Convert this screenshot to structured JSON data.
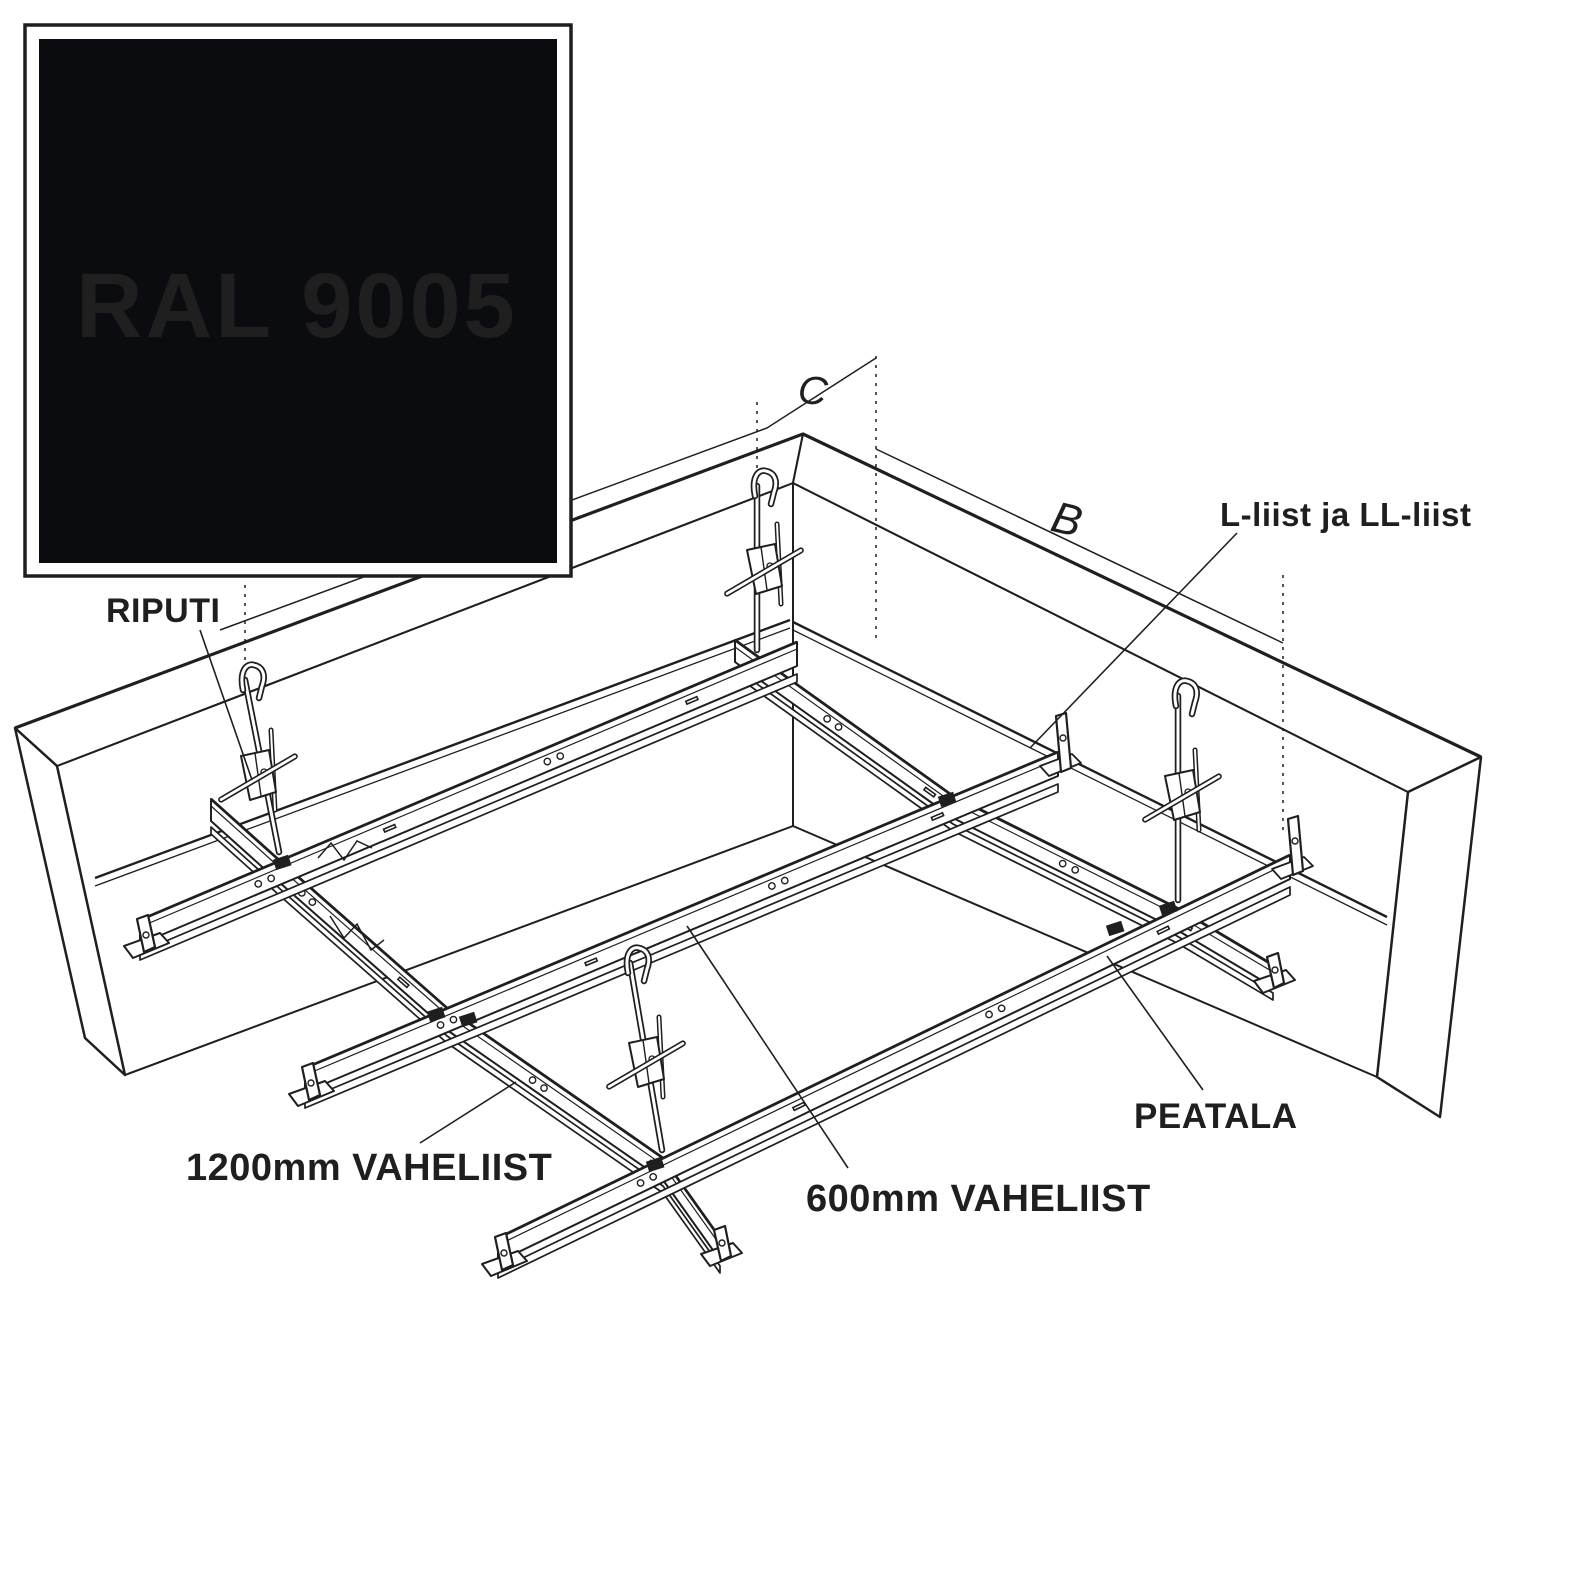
{
  "swatch": {
    "label": "RAL 9005",
    "color": "#0a0c10",
    "text_color": "#ffffff"
  },
  "annotations": {
    "riputi": "RIPUTI",
    "l_liist": "L-liist ja LL-liist",
    "vaheliist_1200": "1200mm VAHELIIST",
    "vaheliist_600": "600mm VAHELIIST",
    "peatala": "PEATALA",
    "dim_b": "B",
    "dim_c": "C"
  },
  "colors": {
    "line": "#1f1f1f",
    "background": "#ffffff"
  }
}
